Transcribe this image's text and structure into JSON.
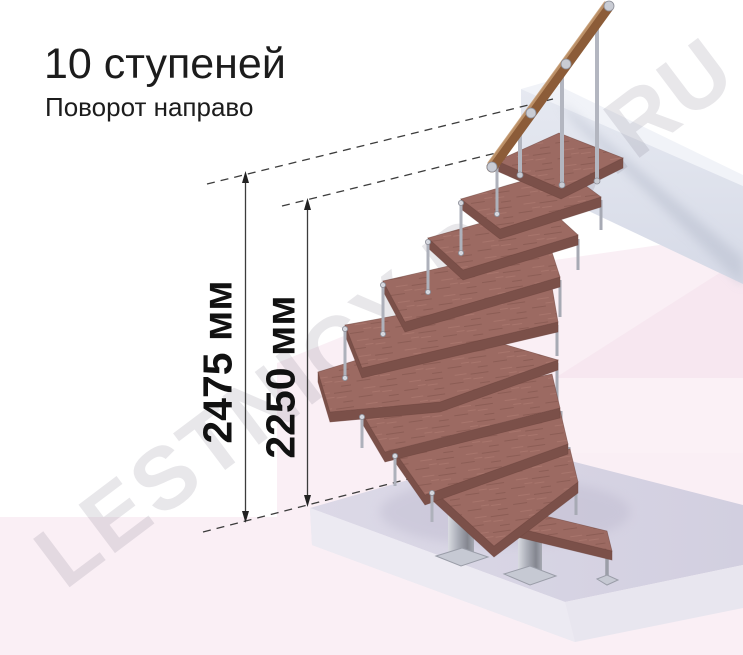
{
  "header": {
    "title": "10 ступеней",
    "subtitle": "Поворот направо"
  },
  "measurements": {
    "height_total": "2475 мм",
    "height_steps": "2250 мм"
  },
  "watermark": {
    "text": "LESTNICY-PRO.RU"
  },
  "illustration": {
    "steps_count": 10,
    "turn_direction": "направо",
    "colors": {
      "tread_wood": "#9c6a62",
      "tread_edge": "#7b5049",
      "handrail_wood": "#8c5c38",
      "metal": "#b3b5bf",
      "landing_beam": "#e2e5ee",
      "floor_platform": "#d8d5e3",
      "floor_pink": "#faeff5",
      "dimension_line": "#3c3c3c",
      "text": "#1c1c1c",
      "watermark": "#c7c5d0"
    }
  }
}
